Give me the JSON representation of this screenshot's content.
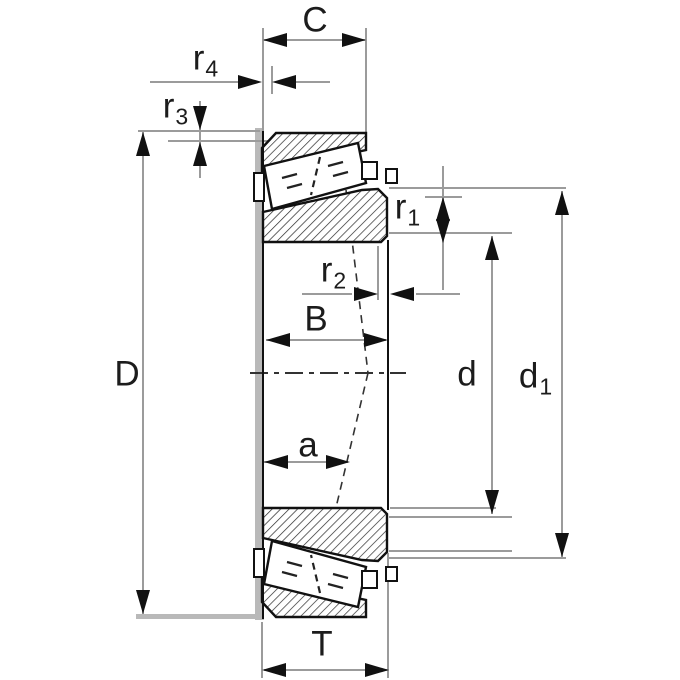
{
  "diagram": {
    "type": "tapered-roller-bearing-cross-section",
    "labels": {
      "C": {
        "text": "C"
      },
      "r4": {
        "text": "r",
        "sub": "4"
      },
      "r3": {
        "text": "r",
        "sub": "3"
      },
      "D": {
        "text": "D"
      },
      "r1": {
        "text": "r",
        "sub": "1"
      },
      "r2": {
        "text": "r",
        "sub": "2"
      },
      "B": {
        "text": "B"
      },
      "a": {
        "text": "a"
      },
      "d": {
        "text": "d"
      },
      "d1": {
        "text": "d",
        "sub": "1"
      },
      "T": {
        "text": "T"
      }
    },
    "colors": {
      "background": "#ffffff",
      "outline": "#111111",
      "dimension_line": "#9b9b9b",
      "thick_reference": "#b9b9b9",
      "hatch": "#2a2a2a",
      "label_text": "#1c1c1c"
    }
  }
}
